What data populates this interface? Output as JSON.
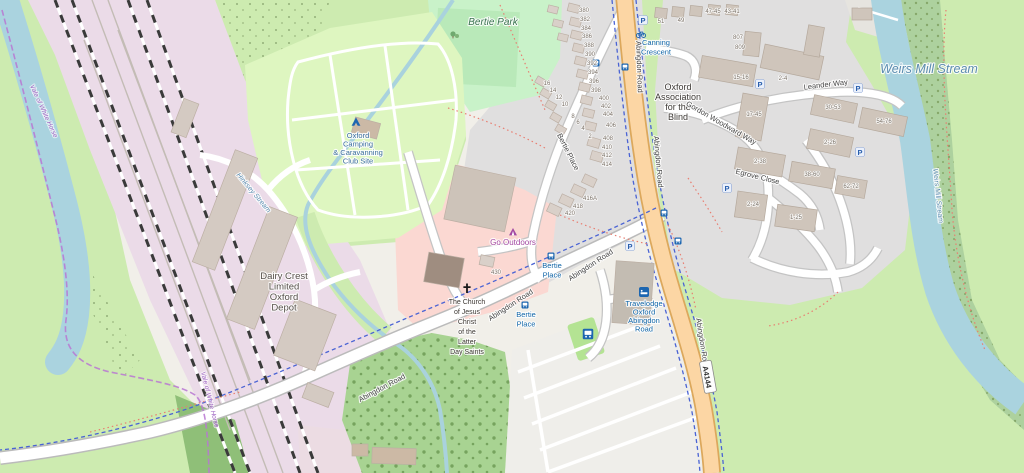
{
  "map": {
    "colors": {
      "base": "#f1efe9",
      "grass": "#cdebb0",
      "park": "#c9f2c9",
      "pitch": "#b9e9b9",
      "campsite": "#def6c0",
      "forest": "#add19e",
      "water": "#aad3df",
      "residential": "#e0dfdf",
      "retail": "#fbd8d2",
      "industrial": "#ebdbe8",
      "building": "#d9d0c9",
      "primary_road": "#fcd6a4",
      "white_road": "#ffffff",
      "cycleway": "#4a63d4",
      "footpath": "#e87e71",
      "boundary": "#b977d2",
      "poi_blue": "#1166a8",
      "poi_purple": "#a349a3"
    },
    "labels": {
      "park": [
        {
          "lines": [
            "Bertie Park"
          ],
          "x": 493,
          "y": 25
        }
      ],
      "camp": [
        {
          "lines": [
            "Oxford",
            "Camping",
            "& Caravanning",
            "Club Site"
          ],
          "x": 358,
          "y": 138,
          "lh": 8.5
        }
      ],
      "places": [
        {
          "lines": [
            "Dairy Crest",
            "Limited",
            "Oxford",
            "Depot"
          ],
          "x": 284,
          "y": 279,
          "lh": 10.5
        }
      ],
      "place_dark": [
        {
          "lines": [
            "Oxford",
            "Association",
            "for the",
            "Blind"
          ],
          "x": 678,
          "y": 90,
          "lh": 10
        }
      ],
      "church": [
        {
          "lines": [
            "The Church",
            "of Jesus",
            "Christ",
            "of the",
            "Latter",
            "Day Saints"
          ],
          "x": 467,
          "y": 304,
          "lh": 10
        }
      ],
      "roads": [
        {
          "text": "Abingdon Road",
          "x": 637,
          "y": 67,
          "rot": 88
        },
        {
          "text": "Abingdon Road",
          "x": 656,
          "y": 162,
          "rot": 85
        },
        {
          "text": "Abingdon Road",
          "x": 592,
          "y": 267,
          "rot": -33
        },
        {
          "text": "Abingdon Road",
          "x": 512,
          "y": 307,
          "rot": -33
        },
        {
          "text": "Abingdon Road",
          "x": 383,
          "y": 390,
          "rot": -28
        },
        {
          "text": "Abingdon Road",
          "x": 700,
          "y": 344,
          "rot": 81
        },
        {
          "text": "Bertie Place",
          "x": 566,
          "y": 153,
          "rot": 63
        },
        {
          "text": "Leander Way",
          "x": 826,
          "y": 87,
          "rot": -7
        },
        {
          "text": "Gordon Woodward Way",
          "x": 720,
          "y": 125,
          "rot": 30
        },
        {
          "text": "Egrove Close",
          "x": 757,
          "y": 179,
          "rot": 14
        }
      ],
      "pois_blue": [
        {
          "lines": [
            "Canning",
            "Crescent"
          ],
          "x": 656,
          "y": 45,
          "lh": 9.5
        },
        {
          "lines": [
            "Bertie",
            "Place"
          ],
          "x": 552,
          "y": 268,
          "lh": 9.5
        },
        {
          "lines": [
            "Bertie",
            "Place"
          ],
          "x": 526,
          "y": 317,
          "lh": 9.5
        },
        {
          "lines": [
            "Travelodge",
            "Oxford",
            "Abingdon",
            "Road"
          ],
          "x": 644,
          "y": 306,
          "lh": 8.5
        }
      ],
      "pois_purple": [
        {
          "text": "Go Outdoors",
          "x": 513,
          "y": 245
        }
      ],
      "water_large": [
        {
          "text": "Weirs Mill Stream",
          "x": 929,
          "y": 73
        }
      ],
      "water_small": [
        {
          "text": "Weirs Mill Stream",
          "x": 936,
          "y": 196,
          "rot": 84
        },
        {
          "text": "Hinksey Stream",
          "x": 252,
          "y": 194,
          "rot": 50
        }
      ],
      "boundaries": [
        {
          "text": "Vale of White Horse",
          "x": 42,
          "y": 112,
          "rot": 65
        },
        {
          "text": "Vale of White Horse",
          "x": 208,
          "y": 400,
          "rot": 76
        }
      ],
      "house_numbers": [
        {
          "text": "380",
          "x": 584,
          "y": 12
        },
        {
          "text": "382",
          "x": 585,
          "y": 21
        },
        {
          "text": "384",
          "x": 586,
          "y": 30
        },
        {
          "text": "386",
          "x": 587,
          "y": 38
        },
        {
          "text": "388",
          "x": 589,
          "y": 47
        },
        {
          "text": "390",
          "x": 590,
          "y": 56
        },
        {
          "text": "392",
          "x": 592,
          "y": 65
        },
        {
          "text": "394",
          "x": 593,
          "y": 74
        },
        {
          "text": "396",
          "x": 594,
          "y": 83
        },
        {
          "text": "398",
          "x": 596,
          "y": 92
        },
        {
          "text": "400",
          "x": 604,
          "y": 100
        },
        {
          "text": "402",
          "x": 606,
          "y": 108
        },
        {
          "text": "404",
          "x": 608,
          "y": 116
        },
        {
          "text": "406",
          "x": 611,
          "y": 127
        },
        {
          "text": "408",
          "x": 608,
          "y": 140
        },
        {
          "text": "410",
          "x": 607,
          "y": 149
        },
        {
          "text": "412",
          "x": 607,
          "y": 157
        },
        {
          "text": "414",
          "x": 607,
          "y": 166
        },
        {
          "text": "416A",
          "x": 590,
          "y": 200
        },
        {
          "text": "418",
          "x": 578,
          "y": 208
        },
        {
          "text": "420",
          "x": 570,
          "y": 215
        },
        {
          "text": "430",
          "x": 496,
          "y": 274
        },
        {
          "text": "16",
          "x": 547,
          "y": 85
        },
        {
          "text": "14",
          "x": 553,
          "y": 92
        },
        {
          "text": "12",
          "x": 559,
          "y": 99
        },
        {
          "text": "10",
          "x": 565,
          "y": 106
        },
        {
          "text": "8",
          "x": 573,
          "y": 118
        },
        {
          "text": "6",
          "x": 578,
          "y": 124
        },
        {
          "text": "4",
          "x": 583,
          "y": 130
        },
        {
          "text": "2",
          "x": 590,
          "y": 138
        },
        {
          "text": "51",
          "x": 661,
          "y": 23
        },
        {
          "text": "49",
          "x": 681,
          "y": 22
        },
        {
          "text": "47-45",
          "x": 713,
          "y": 13
        },
        {
          "text": "43-41",
          "x": 732,
          "y": 13
        },
        {
          "text": "807",
          "x": 738,
          "y": 39
        },
        {
          "text": "809",
          "x": 740,
          "y": 49
        },
        {
          "text": "15-16",
          "x": 741,
          "y": 79
        },
        {
          "text": "2-4",
          "x": 783,
          "y": 80
        },
        {
          "text": "17-45",
          "x": 754,
          "y": 116
        },
        {
          "text": "30-53",
          "x": 833,
          "y": 109
        },
        {
          "text": "54-76",
          "x": 884,
          "y": 123
        },
        {
          "text": "2-26",
          "x": 830,
          "y": 144
        },
        {
          "text": "2-38",
          "x": 760,
          "y": 163
        },
        {
          "text": "38-60",
          "x": 812,
          "y": 176
        },
        {
          "text": "62-72",
          "x": 851,
          "y": 188
        },
        {
          "text": "2-24",
          "x": 753,
          "y": 206
        },
        {
          "text": "1-25",
          "x": 796,
          "y": 219
        }
      ]
    },
    "road_badge": {
      "text": "A4144",
      "x": 707,
      "y": 377,
      "rot": 80
    },
    "icons": [
      {
        "t": "parking",
        "x": 643,
        "y": 20
      },
      {
        "t": "parking",
        "x": 760,
        "y": 84
      },
      {
        "t": "parking",
        "x": 858,
        "y": 88
      },
      {
        "t": "parking",
        "x": 727,
        "y": 188
      },
      {
        "t": "parking",
        "x": 860,
        "y": 152
      },
      {
        "t": "parking",
        "x": 630,
        "y": 246
      },
      {
        "t": "bus-stop",
        "x": 625,
        "y": 67
      },
      {
        "t": "bus-stop",
        "x": 596,
        "y": 63
      },
      {
        "t": "bus-stop",
        "x": 551,
        "y": 256
      },
      {
        "t": "bus-stop",
        "x": 525,
        "y": 305
      },
      {
        "t": "bus-stop",
        "x": 664,
        "y": 213
      },
      {
        "t": "bus-stop",
        "x": 678,
        "y": 241
      },
      {
        "t": "bus-big",
        "x": 588,
        "y": 334
      },
      {
        "t": "bicycle",
        "x": 641,
        "y": 34
      },
      {
        "t": "tent",
        "x": 356,
        "y": 122
      },
      {
        "t": "cross",
        "x": 467,
        "y": 288
      },
      {
        "t": "shop",
        "x": 513,
        "y": 232
      },
      {
        "t": "bed",
        "x": 644,
        "y": 292
      },
      {
        "t": "trees",
        "x": 453,
        "y": 34
      }
    ]
  }
}
